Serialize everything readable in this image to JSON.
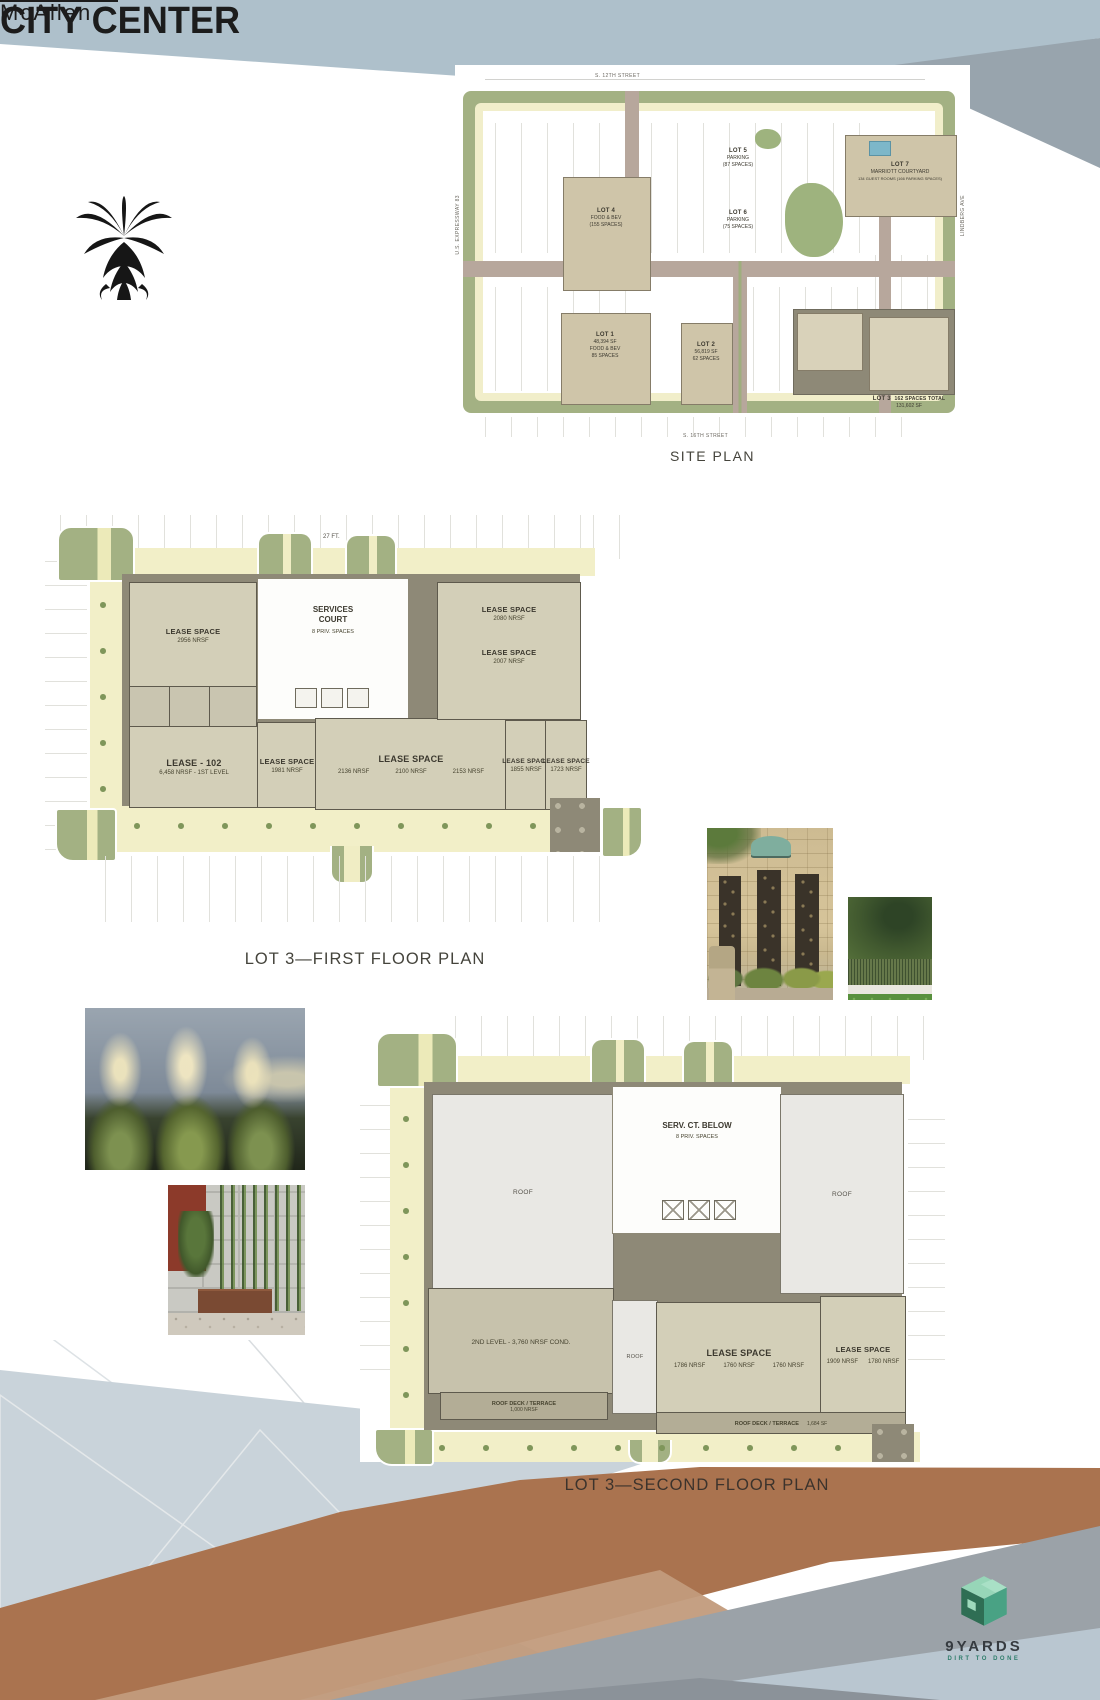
{
  "brand": {
    "name_top": "McAllen",
    "name_main": "CITY CENTER"
  },
  "captions": {
    "site_plan": "SITE PLAN",
    "first_floor": "LOT 3—FIRST FLOOR PLAN",
    "second_floor": "LOT 3—SECOND FLOOR PLAN"
  },
  "site_plan": {
    "streets": {
      "top": "S. 12TH STREET",
      "left": "U.S. EXPRESSWAY 83",
      "right": "LINDBERG AVE",
      "bottom": "S. 16TH STREET"
    },
    "lot1": {
      "l1": "LOT 1",
      "l2": "48,394 SF",
      "l3": "FOOD & BEV",
      "l4": "85 SPACES"
    },
    "lot2": {
      "l1": "LOT 2",
      "l2": "56,819 SF",
      "l3": "62 SPACES"
    },
    "lot3": {
      "l1": "LOT 3",
      "l2": "131,602 SF",
      "l3": "162 SPACES TOTAL"
    },
    "lot4": {
      "l1": "LOT 4",
      "l2": "FOOD & BEV",
      "l3": "(155 SPACES)"
    },
    "lot5": {
      "l1": "LOT 5",
      "l2": "PARKING",
      "l3": "(87 SPACES)"
    },
    "lot6": {
      "l1": "LOT 6",
      "l2": "PARKING",
      "l3": "(75 SPACES)"
    },
    "lot7": {
      "l1": "LOT 7",
      "l2": "MARRIOTT COURTYARD",
      "l3": "134 GUEST ROOMS  (166 PARKING SPACES)"
    }
  },
  "first_floor": {
    "dim": "27 FT.",
    "court": {
      "l1": "SERVICES",
      "l2": "COURT",
      "l3": "8 PRIV. SPACES"
    },
    "s2956": {
      "l1": "LEASE SPACE",
      "l2": "2956 NRSF"
    },
    "s2080": {
      "l1": "LEASE SPACE",
      "l2": "2080 NRSF"
    },
    "s2007": {
      "l1": "LEASE SPACE",
      "l2": "2007 NRSF"
    },
    "s102": {
      "l1": "LEASE - 102",
      "l2": "6,458 NRSF - 1ST LEVEL"
    },
    "s1981": {
      "l1": "LEASE SPACE",
      "l2": "1981 NRSF"
    },
    "smid": {
      "l1": "LEASE SPACE",
      "a": "2136 NRSF",
      "b": "2100 NRSF",
      "c": "2153 NRSF"
    },
    "s1855": {
      "l1": "LEASE SPACE",
      "l2": "1855 NRSF"
    },
    "s1723": {
      "l1": "LEASE SPACE",
      "l2": "1723 NRSF"
    }
  },
  "second_floor": {
    "roof": "ROOF",
    "court": {
      "l1": "SERV. CT. BELOW",
      "l2": "8 PRIV. SPACES"
    },
    "level2": "2ND LEVEL - 3,760 NRSF COND.",
    "smid": {
      "l1": "LEASE SPACE",
      "a": "1786 NRSF",
      "b": "1760 NRSF",
      "c": "1760 NRSF"
    },
    "sright": {
      "l1": "LEASE SPACE",
      "a": "1909 NRSF",
      "b": "1780 NRSF"
    },
    "deck1": {
      "l1": "ROOF DECK / TERRACE",
      "l2": "1,000 NRSF"
    },
    "deck2": {
      "l1": "ROOF DECK / TERRACE",
      "l2": "1,684 SF"
    }
  },
  "footer": {
    "logo": "9YARDS",
    "tagline": "DIRT TO DONE"
  },
  "colors": {
    "top_band": "#aec0cb",
    "top_gray": "#98a4ad",
    "brown": "#aa734f",
    "tan": "#c29b7c",
    "gray_wedge": "#9ba2a8",
    "pale_blue": "#b9c6d0",
    "plan_green": "#a3b183",
    "plan_yellow": "#f2efc8",
    "plan_walk": "#8e8977",
    "plan_space": "#d3cfb8",
    "logo_green_light": "#97d6b8",
    "logo_green_dark": "#2f6e54",
    "logo_green_mid": "#49a284"
  }
}
